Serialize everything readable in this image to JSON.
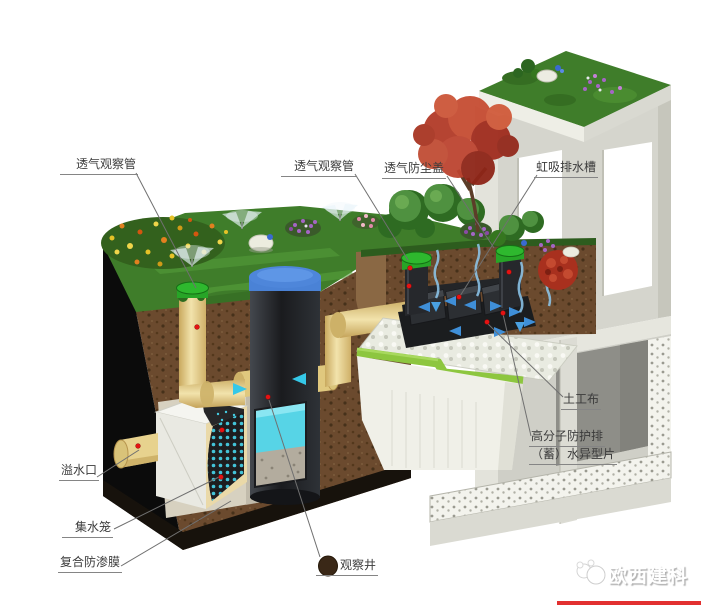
{
  "diagram": {
    "labels": {
      "vent_pipe_left": "透气观察管",
      "vent_pipe_mid": "透气观察管",
      "vent_dust_cap": "透气防尘盖",
      "siphon_channel": "虹吸排水槽",
      "geotextile": "土工布",
      "drain_sheet_line1": "高分子防护排",
      "drain_sheet_line2": "（蓄）水异型片",
      "overflow_outlet": "溢水口",
      "collection_cage": "集水笼",
      "composite_membrane": "复合防渗膜",
      "observation_well": "观察井"
    },
    "watermark": "欧西建科",
    "colors": {
      "grass": "#3f7d2a",
      "soil": "#6b4a2e",
      "pipe_yellow": "#e7d28e",
      "lid_blue": "#4a82d6",
      "water_cyan": "#57d4e6",
      "cap_green": "#2eb82e",
      "marker_red": "#e51212",
      "membrane_black": "#17120c",
      "concrete": "#d5d5cd",
      "drain_green": "#8dc63f"
    }
  }
}
